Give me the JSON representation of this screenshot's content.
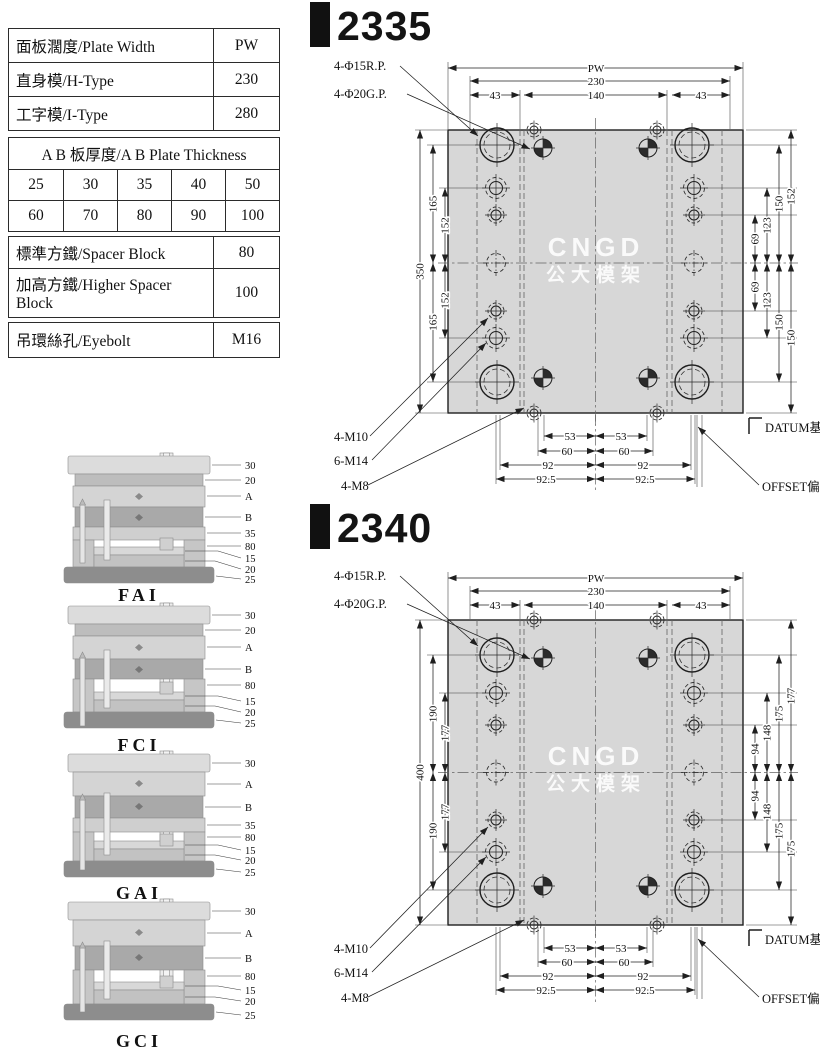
{
  "tables": {
    "plate": [
      {
        "label": "面板濶度/Plate Width",
        "value": "PW"
      },
      {
        "label": "直身模/H-Type",
        "value": "230"
      },
      {
        "label": "工字模/I-Type",
        "value": "280"
      }
    ],
    "thickness": {
      "header": "A B 板厚度/A B Plate Thickness",
      "row1": [
        "25",
        "30",
        "35",
        "40",
        "50"
      ],
      "row2": [
        "60",
        "70",
        "80",
        "90",
        "100"
      ]
    },
    "spacer": [
      {
        "label": "標準方鐵/Spacer Block",
        "value": "80"
      },
      {
        "label": "加高方鐵/Higher Spacer Block",
        "value": "100"
      }
    ],
    "eyebolt": {
      "label": "吊環絲孔/Eyebolt",
      "value": "M16"
    }
  },
  "sections": [
    {
      "name": "FAI",
      "labels": [
        "30",
        "20",
        "A",
        "B",
        "35",
        "80",
        "15",
        "20",
        "25"
      ]
    },
    {
      "name": "FCI",
      "labels": [
        "30",
        "20",
        "A",
        "B",
        "80",
        "15",
        "20",
        "25"
      ]
    },
    {
      "name": "GAI",
      "labels": [
        "30",
        "A",
        "B",
        "35",
        "80",
        "15",
        "20",
        "25"
      ]
    },
    {
      "name": "GCI",
      "labels": [
        "30",
        "A",
        "B",
        "80",
        "15",
        "20",
        "25"
      ]
    }
  ],
  "watermark": {
    "line1": "CNGD",
    "line2": "公大模架"
  },
  "drawings": [
    {
      "title": "2335",
      "leaders": {
        "rp": "4-Φ15R.P.",
        "gp": "4-Φ20G.P.",
        "m10": "4-M10",
        "m14": "6-M14",
        "m8": "4-M8",
        "datum": "DATUM基準面",
        "offset": "OFFSET偏孔"
      },
      "dims": {
        "pw": "PW",
        "width": "230",
        "inner_width": "140",
        "edge_l": "43",
        "edge_r": "43",
        "height": "350",
        "left_outer_top": "165",
        "left_inner_top": "152",
        "left_inner_bot": "152",
        "left_outer_bot": "165",
        "right_1_top": "69",
        "right_2_top": "123",
        "right_3_top": "150",
        "right_4_top": "152",
        "right_1_bot": "69",
        "right_2_bot": "123",
        "right_3_bot": "150",
        "right_4_bot": "150",
        "bot_1_l": "53",
        "bot_1_r": "53",
        "bot_2_l": "60",
        "bot_2_r": "60",
        "bot_3_l": "92",
        "bot_3_r": "92",
        "bot_4_l": "92.5",
        "bot_4_r": "92.5"
      }
    },
    {
      "title": "2340",
      "leaders": {
        "rp": "4-Φ15R.P.",
        "gp": "4-Φ20G.P.",
        "m10": "4-M10",
        "m14": "6-M14",
        "m8": "4-M8",
        "datum": "DATUM基準面",
        "offset": "OFFSET偏孔"
      },
      "dims": {
        "pw": "PW",
        "width": "230",
        "inner_width": "140",
        "edge_l": "43",
        "edge_r": "43",
        "height": "400",
        "left_outer_top": "190",
        "left_inner_top": "177",
        "left_inner_bot": "177",
        "left_outer_bot": "190",
        "right_1_top": "94",
        "right_2_top": "148",
        "right_3_top": "175",
        "right_4_top": "177",
        "right_1_bot": "94",
        "right_2_bot": "148",
        "right_3_bot": "175",
        "right_4_bot": "175",
        "bot_1_l": "53",
        "bot_1_r": "53",
        "bot_2_l": "60",
        "bot_2_r": "60",
        "bot_3_l": "92",
        "bot_3_r": "92",
        "bot_4_l": "92.5",
        "bot_4_r": "92.5"
      }
    }
  ]
}
